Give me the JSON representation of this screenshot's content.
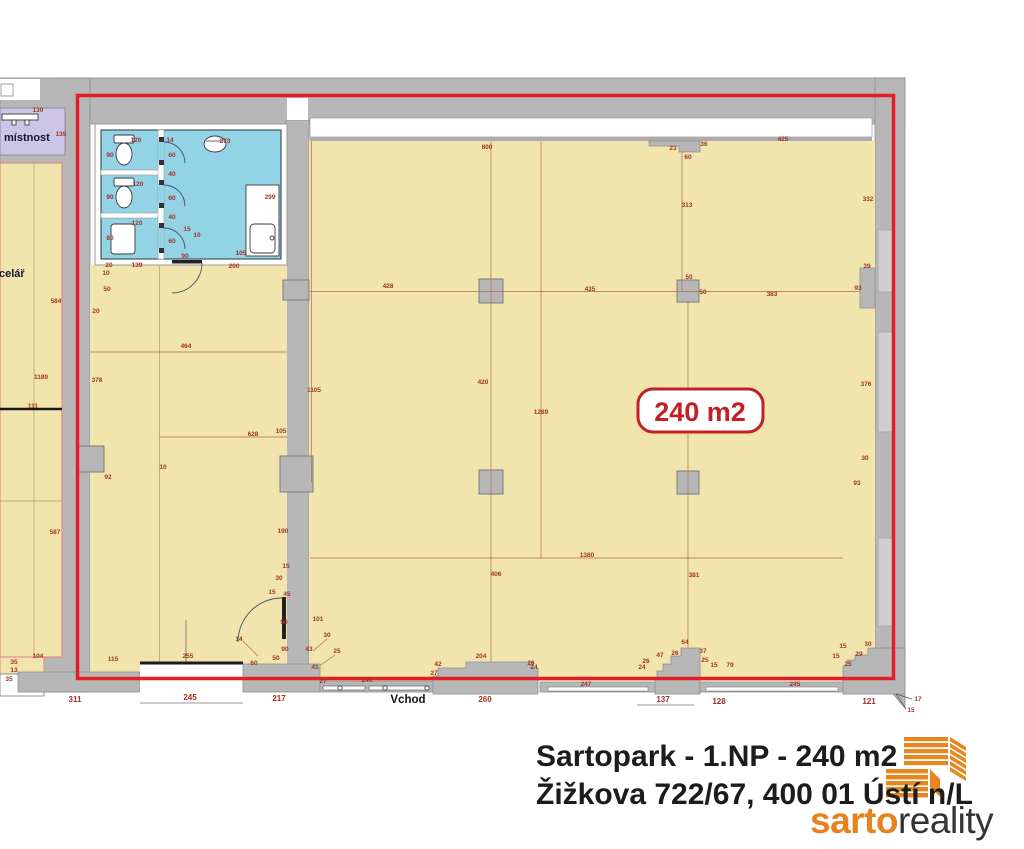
{
  "labels": {
    "room_top_left": "místnost",
    "room_left_fragment": "celář",
    "entrance": "Vchod",
    "area_badge": "240 m2"
  },
  "footer": {
    "line1": "Sartopark - 1.NP - 240 m2",
    "line2": "Žižkova 722/67, 400 01 Ústí n/L",
    "brand_first": "sarto",
    "brand_second": "reality"
  },
  "colors": {
    "wall_gray": "#b7b7b7",
    "floor_yellow": "#f2e4ad",
    "bathroom_cyan": "#92d3e6",
    "room_purple": "#cdc5e5",
    "outline_red": "#e31e24",
    "dimension_red": "#9e3524",
    "badge_red": "#c32026",
    "logo_orange": "#e8871e",
    "brand_dark": "#333333"
  },
  "plan": {
    "dimensions": [
      {
        "x": 38,
        "y": 112,
        "v": "130"
      },
      {
        "x": 61,
        "y": 136,
        "v": "135"
      },
      {
        "x": 56,
        "y": 303,
        "v": "584"
      },
      {
        "x": 41,
        "y": 379,
        "v": "1189"
      },
      {
        "x": 33,
        "y": 408,
        "v": "111"
      },
      {
        "x": 55,
        "y": 534,
        "v": "587"
      },
      {
        "x": 38,
        "y": 658,
        "v": "104"
      },
      {
        "x": 14,
        "y": 664,
        "v": "35"
      },
      {
        "x": 14,
        "y": 672,
        "v": "13"
      },
      {
        "x": 9,
        "y": 681,
        "v": "35"
      },
      {
        "x": 75,
        "y": 702,
        "v": "311",
        "big": 1
      },
      {
        "x": 136,
        "y": 142,
        "v": "120"
      },
      {
        "x": 110,
        "y": 157,
        "v": "90"
      },
      {
        "x": 138,
        "y": 186,
        "v": "120"
      },
      {
        "x": 110,
        "y": 199,
        "v": "90"
      },
      {
        "x": 137,
        "y": 225,
        "v": "120"
      },
      {
        "x": 110,
        "y": 240,
        "v": "80"
      },
      {
        "x": 170,
        "y": 142,
        "v": "14"
      },
      {
        "x": 172,
        "y": 157,
        "v": "60"
      },
      {
        "x": 172,
        "y": 176,
        "v": "40"
      },
      {
        "x": 172,
        "y": 200,
        "v": "60"
      },
      {
        "x": 172,
        "y": 219,
        "v": "40"
      },
      {
        "x": 172,
        "y": 243,
        "v": "60"
      },
      {
        "x": 187,
        "y": 231,
        "v": "15"
      },
      {
        "x": 197,
        "y": 237,
        "v": "10"
      },
      {
        "x": 225,
        "y": 143,
        "v": "273"
      },
      {
        "x": 270,
        "y": 199,
        "v": "299"
      },
      {
        "x": 241,
        "y": 255,
        "v": "105"
      },
      {
        "x": 185,
        "y": 258,
        "v": "90"
      },
      {
        "x": 109,
        "y": 267,
        "v": "20"
      },
      {
        "x": 106,
        "y": 275,
        "v": "10"
      },
      {
        "x": 107,
        "y": 291,
        "v": "50"
      },
      {
        "x": 96,
        "y": 313,
        "v": "20"
      },
      {
        "x": 137,
        "y": 267,
        "v": "139"
      },
      {
        "x": 234,
        "y": 268,
        "v": "200"
      },
      {
        "x": 186,
        "y": 348,
        "v": "464"
      },
      {
        "x": 97,
        "y": 382,
        "v": "378"
      },
      {
        "x": 253,
        "y": 436,
        "v": "628"
      },
      {
        "x": 281,
        "y": 433,
        "v": "105"
      },
      {
        "x": 163,
        "y": 469,
        "v": "10"
      },
      {
        "x": 108,
        "y": 479,
        "v": "92"
      },
      {
        "x": 113,
        "y": 661,
        "v": "115"
      },
      {
        "x": 188,
        "y": 658,
        "v": "255"
      },
      {
        "x": 254,
        "y": 665,
        "v": "60"
      },
      {
        "x": 276,
        "y": 660,
        "v": "50"
      },
      {
        "x": 239,
        "y": 641,
        "v": "14"
      },
      {
        "x": 314,
        "y": 392,
        "v": "1105"
      },
      {
        "x": 283,
        "y": 533,
        "v": "190"
      },
      {
        "x": 286,
        "y": 568,
        "v": "15"
      },
      {
        "x": 279,
        "y": 580,
        "v": "30"
      },
      {
        "x": 272,
        "y": 594,
        "v": "15"
      },
      {
        "x": 287,
        "y": 596,
        "v": "45"
      },
      {
        "x": 284,
        "y": 624,
        "v": "90"
      },
      {
        "x": 318,
        "y": 621,
        "v": "101"
      },
      {
        "x": 285,
        "y": 651,
        "v": "90"
      },
      {
        "x": 309,
        "y": 651,
        "v": "43"
      },
      {
        "x": 327,
        "y": 637,
        "v": "30"
      },
      {
        "x": 337,
        "y": 653,
        "v": "25"
      },
      {
        "x": 315,
        "y": 669,
        "v": "41"
      },
      {
        "x": 323,
        "y": 683,
        "v": "27"
      },
      {
        "x": 487,
        "y": 149,
        "v": "800"
      },
      {
        "x": 783,
        "y": 141,
        "v": "425"
      },
      {
        "x": 673,
        "y": 150,
        "v": "23"
      },
      {
        "x": 704,
        "y": 146,
        "v": "36"
      },
      {
        "x": 688,
        "y": 159,
        "v": "60"
      },
      {
        "x": 687,
        "y": 207,
        "v": "313"
      },
      {
        "x": 868,
        "y": 201,
        "v": "332"
      },
      {
        "x": 388,
        "y": 288,
        "v": "428"
      },
      {
        "x": 590,
        "y": 291,
        "v": "435"
      },
      {
        "x": 689,
        "y": 279,
        "v": "50"
      },
      {
        "x": 703,
        "y": 294,
        "v": "50"
      },
      {
        "x": 772,
        "y": 296,
        "v": "383"
      },
      {
        "x": 858,
        "y": 290,
        "v": "93"
      },
      {
        "x": 867,
        "y": 268,
        "v": "39"
      },
      {
        "x": 483,
        "y": 384,
        "v": "420"
      },
      {
        "x": 541,
        "y": 414,
        "v": "1289"
      },
      {
        "x": 866,
        "y": 386,
        "v": "376"
      },
      {
        "x": 865,
        "y": 460,
        "v": "30"
      },
      {
        "x": 857,
        "y": 485,
        "v": "93"
      },
      {
        "x": 587,
        "y": 557,
        "v": "1380"
      },
      {
        "x": 496,
        "y": 576,
        "v": "406"
      },
      {
        "x": 694,
        "y": 577,
        "v": "381"
      },
      {
        "x": 190,
        "y": 700,
        "v": "245",
        "big": 1
      },
      {
        "x": 279,
        "y": 701,
        "v": "217",
        "big": 1
      },
      {
        "x": 367,
        "y": 682,
        "v": "246"
      },
      {
        "x": 485,
        "y": 702,
        "v": "260",
        "big": 1
      },
      {
        "x": 481,
        "y": 658,
        "v": "204"
      },
      {
        "x": 438,
        "y": 666,
        "v": "42"
      },
      {
        "x": 434,
        "y": 675,
        "v": "27"
      },
      {
        "x": 531,
        "y": 665,
        "v": "26"
      },
      {
        "x": 534,
        "y": 669,
        "v": "24"
      },
      {
        "x": 586,
        "y": 686,
        "v": "247"
      },
      {
        "x": 663,
        "y": 702,
        "v": "137",
        "big": 1
      },
      {
        "x": 719,
        "y": 704,
        "v": "128",
        "big": 1
      },
      {
        "x": 685,
        "y": 644,
        "v": "64"
      },
      {
        "x": 660,
        "y": 657,
        "v": "47"
      },
      {
        "x": 675,
        "y": 655,
        "v": "26"
      },
      {
        "x": 703,
        "y": 653,
        "v": "37"
      },
      {
        "x": 705,
        "y": 662,
        "v": "25"
      },
      {
        "x": 714,
        "y": 667,
        "v": "15"
      },
      {
        "x": 730,
        "y": 667,
        "v": "79"
      },
      {
        "x": 642,
        "y": 669,
        "v": "24"
      },
      {
        "x": 646,
        "y": 663,
        "v": "26"
      },
      {
        "x": 795,
        "y": 686,
        "v": "245"
      },
      {
        "x": 869,
        "y": 704,
        "v": "121",
        "big": 1
      },
      {
        "x": 843,
        "y": 648,
        "v": "15"
      },
      {
        "x": 868,
        "y": 646,
        "v": "30"
      },
      {
        "x": 836,
        "y": 658,
        "v": "15"
      },
      {
        "x": 859,
        "y": 656,
        "v": "29"
      },
      {
        "x": 848,
        "y": 666,
        "v": "25"
      },
      {
        "x": 918,
        "y": 701,
        "v": "17"
      },
      {
        "x": 911,
        "y": 712,
        "v": "15"
      }
    ]
  }
}
